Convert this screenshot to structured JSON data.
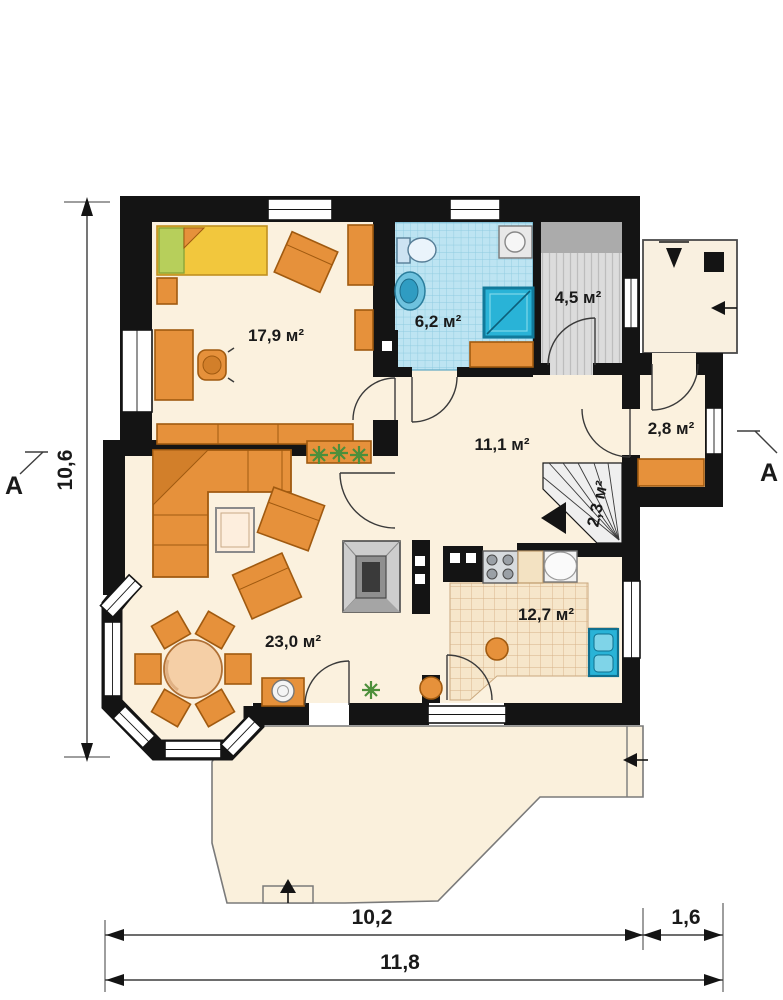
{
  "rooms": {
    "bedroom_area": "17,9 м²",
    "bathroom_area": "6,2 м²",
    "utility_area": "4,5 м²",
    "hall_area": "11,1 м²",
    "vestibule_area": "2,8 м²",
    "stairs_area": "2,3 м²",
    "kitchen_area": "12,7 м²",
    "living_area": "23,0 м²"
  },
  "dimensions": {
    "side_height": "10,6",
    "front_width": "10,2",
    "side_extension": "1,6",
    "total_width": "11,8"
  },
  "section_markers": {
    "left": "A",
    "right": "A"
  },
  "colors": {
    "wall": "#141414",
    "floor": "#fbf1de",
    "bathroom_tile": "#bde4f2",
    "utility_floor": "#dcdcdc",
    "furniture_orange": "#e6913b",
    "fixture_blue": "#29b3d7",
    "bed_yellow": "#f2c73d",
    "plant_green": "#4d8f3b"
  }
}
